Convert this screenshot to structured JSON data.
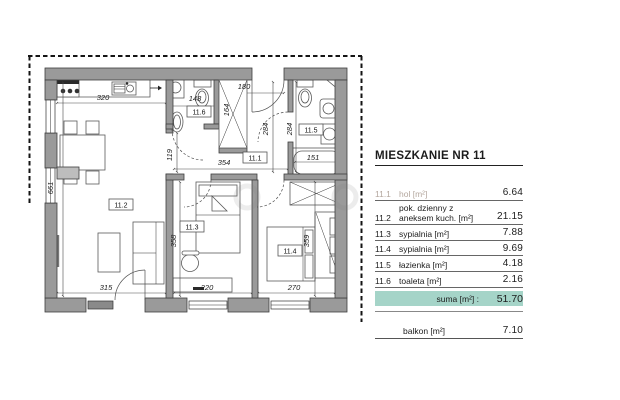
{
  "title": "MIESZKANIE NR 11",
  "table": {
    "rows": [
      {
        "no": "11.1",
        "name": "hol [m²]",
        "value": "6.64",
        "faded": true
      },
      {
        "no": "11.2",
        "name": "pok. dzienny z\naneksem kuch. [m²]",
        "value": "21.15",
        "faded": false
      },
      {
        "no": "11.3",
        "name": "sypialnia [m²]",
        "value": "7.88",
        "faded": false
      },
      {
        "no": "11.4",
        "name": "sypialnia [m²]",
        "value": "9.69",
        "faded": false
      },
      {
        "no": "11.5",
        "name": "łazienka [m²]",
        "value": "4.18",
        "faded": false
      },
      {
        "no": "11.6",
        "name": "toaleta [m²]",
        "value": "2.16",
        "faded": false
      }
    ],
    "sum": {
      "label": "suma [m²] :",
      "value": "51.70"
    },
    "balcony": {
      "label": "balkon [m²]",
      "value": "7.10"
    }
  },
  "colors": {
    "sum_highlight": "#a5d4c8",
    "wall_gray": "#9a9a9a"
  },
  "plan": {
    "room_labels": [
      {
        "text": "11.1",
        "x": 255,
        "y": 158
      },
      {
        "text": "11.2",
        "x": 121,
        "y": 205
      },
      {
        "text": "11.3",
        "x": 192,
        "y": 227
      },
      {
        "text": "11.4",
        "x": 290,
        "y": 251
      },
      {
        "text": "11.5",
        "x": 311,
        "y": 130
      },
      {
        "text": "11.6",
        "x": 199,
        "y": 112
      }
    ],
    "dimensions": [
      {
        "text": "320",
        "x": 103,
        "y": 100,
        "rot": 0
      },
      {
        "text": "661",
        "x": 53,
        "y": 188,
        "rot": -90
      },
      {
        "text": "315",
        "x": 106,
        "y": 290,
        "rot": 0
      },
      {
        "text": "220",
        "x": 207,
        "y": 290,
        "rot": 0
      },
      {
        "text": "270",
        "x": 294,
        "y": 290,
        "rot": 0
      },
      {
        "text": "358",
        "x": 176,
        "y": 241,
        "rot": -90
      },
      {
        "text": "359",
        "x": 309,
        "y": 241,
        "rot": -90
      },
      {
        "text": "284",
        "x": 268,
        "y": 129,
        "rot": -90
      },
      {
        "text": "284",
        "x": 292,
        "y": 129,
        "rot": -90
      },
      {
        "text": "164",
        "x": 229,
        "y": 110,
        "rot": -90
      },
      {
        "text": "119",
        "x": 172,
        "y": 155,
        "rot": -90
      },
      {
        "text": "180",
        "x": 244,
        "y": 89,
        "rot": 0
      },
      {
        "text": "354",
        "x": 224,
        "y": 165,
        "rot": 0
      },
      {
        "text": "148",
        "x": 195,
        "y": 101,
        "rot": 0
      },
      {
        "text": "151",
        "x": 313,
        "y": 160,
        "rot": 0
      }
    ]
  }
}
